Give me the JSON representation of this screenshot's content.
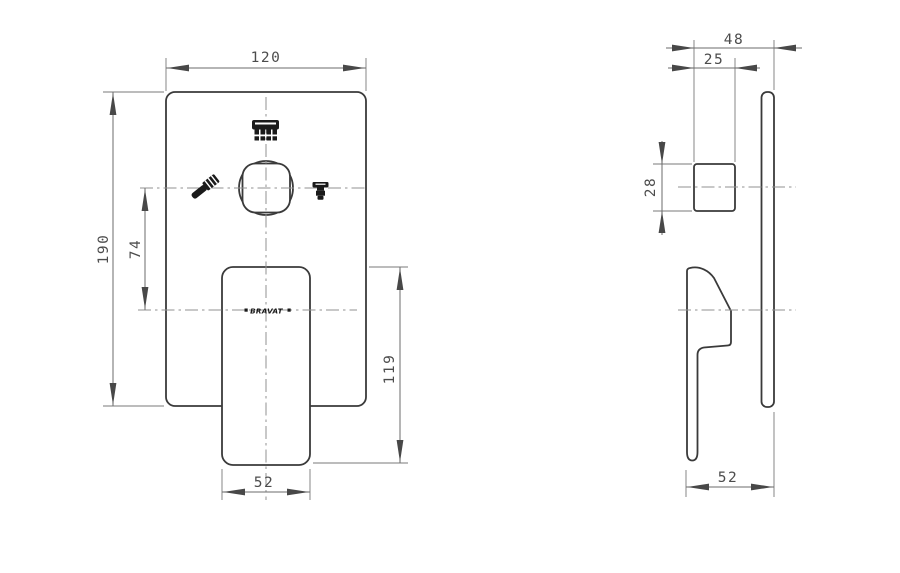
{
  "drawing_type": "concealed-shower-mixer-technical-drawing",
  "front_view": {
    "dims": {
      "plate_width": "120",
      "plate_height": "190",
      "center_to_handle_axis": "74",
      "handle_length": "119",
      "handle_width": "52"
    },
    "logo_text": "BRAVAT",
    "icons": [
      "overhead-shower-icon",
      "hand-shower-icon",
      "spout-icon"
    ]
  },
  "side_view": {
    "dims": {
      "total_depth": "48",
      "knob_depth": "25",
      "knob_height": "28",
      "handle_depth": "52"
    }
  },
  "colors": {
    "background": "#ffffff",
    "part_outline": "#3a3a3a",
    "dimension_lines": "#6b6b6b",
    "dimension_text": "#4c4c4c",
    "centerline": "#929292",
    "icon_fill": "#1a1a1a"
  }
}
